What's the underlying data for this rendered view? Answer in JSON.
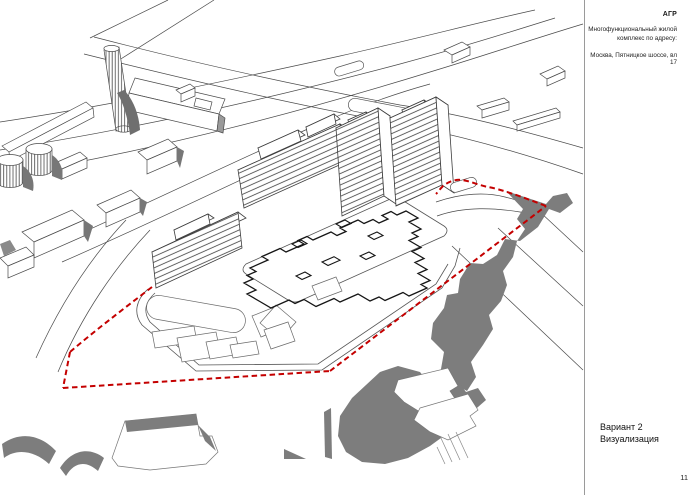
{
  "sidebar": {
    "stamp": "АГР",
    "project_line1": "Многофункциональный жилой",
    "project_line2": "комплекс по адресу:",
    "address": "Москва, Пятницкое шоссе, вл 17",
    "caption_line1": "Вариант 2",
    "caption_line2": "Визуализация",
    "page_number": "11"
  },
  "drawing": {
    "site_boundary_color": "#c40000",
    "context_silhouette_color": "#7d7d7d",
    "line_color": "#3d3d3d",
    "background": "#ffffff"
  }
}
